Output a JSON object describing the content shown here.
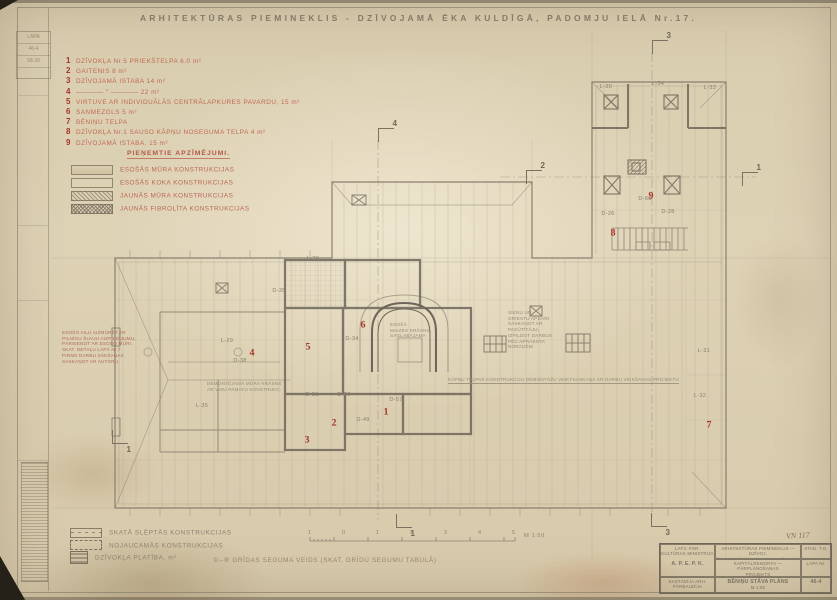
{
  "colors": {
    "paper": "#dcd0b4",
    "ink": "#7d7466",
    "accent_red": "#a8342a"
  },
  "title": "ARHITEKTŪRAS PIEMINEKLIS - DZĪVOJAMĀ ĒKA KULDĪGĀ, PADOMJU IELĀ Nr.17.",
  "corner_stamp": {
    "lines": [
      "LAPA",
      "46-4",
      "58-20"
    ]
  },
  "room_list": {
    "items": [
      {
        "num": "1",
        "text": "DZĪVOKĻA Nr.5 PRIEKŠTELPA 6.0 m²"
      },
      {
        "num": "2",
        "text": "GAITENIS 8 m²"
      },
      {
        "num": "3",
        "text": "DZĪVOJAMĀ ISTABA 14 m²"
      },
      {
        "num": "4",
        "text": "———— ʺ ————  22 m²"
      },
      {
        "num": "5",
        "text": "VIRTUVE AR INDIVIDUĀLĀS CENTRĀLAPKURES PAVARDU, 15 m²"
      },
      {
        "num": "6",
        "text": "SANMEZGLS 5 m²"
      },
      {
        "num": "7",
        "text": "BĒNIŅU TELPA"
      },
      {
        "num": "8",
        "text": "DZĪVOKĻA Nr.1 SAUSO KĀPŅU NOSEGUMA TELPA 4 m²"
      },
      {
        "num": "9",
        "text": "DZĪVOJAMĀ ISTABA, 15 m²"
      }
    ]
  },
  "symbols_legend": {
    "heading": "PIEŅEMTIE APZĪMĒJUMI.",
    "items": [
      {
        "label": "ESOŠĀS MŪRA KONSTRUKCIJAS",
        "swatch": "existing-masonry"
      },
      {
        "label": "ESOŠĀS KOKA KONSTRUKCIJAS",
        "swatch": "existing-wood"
      },
      {
        "label": "JAUNĀS MŪRA KONSTRUKCIJAS",
        "swatch": "new-masonry"
      },
      {
        "label": "JAUNĀS FIBROLĪTA KONSTRUKCIJAS",
        "swatch": "new-fibrolite"
      }
    ]
  },
  "bottom_legend": {
    "items": [
      {
        "label": "SKATĀ SLĒPTĀS KONSTRUKCIJAS",
        "swatch": "hidden"
      },
      {
        "label": "NOJAUCAMĀS KONSTRUKCIJAS",
        "swatch": "demolish"
      },
      {
        "label": "DZĪVOKĻA PLATĪBA, m²",
        "swatch": "area"
      }
    ],
    "floor_note": "①–⑨  GRĪDAS SEGUMA VEIDS (SKAT. GRĪDU SEGUMU TABULĀ)",
    "scale_ticks": [
      "1",
      "0",
      "1",
      "2",
      "3",
      "4",
      "5"
    ],
    "scale_label": "M 1:50"
  },
  "plan": {
    "labels": [
      {
        "text": "L-38",
        "x": 313,
        "y": 259
      },
      {
        "text": "D-35",
        "x": 279,
        "y": 291
      },
      {
        "text": "D-34",
        "x": 352,
        "y": 339
      },
      {
        "text": "D-51",
        "x": 312,
        "y": 395
      },
      {
        "text": "D-58",
        "x": 344,
        "y": 395
      },
      {
        "text": "D-57",
        "x": 396,
        "y": 400
      },
      {
        "text": "D-49",
        "x": 363,
        "y": 420
      },
      {
        "text": "L-29",
        "x": 227,
        "y": 341
      },
      {
        "text": "D-38",
        "x": 240,
        "y": 361
      },
      {
        "text": "L-35",
        "x": 202,
        "y": 406
      },
      {
        "text": "L-31",
        "x": 704,
        "y": 351
      },
      {
        "text": "L-32",
        "x": 700,
        "y": 396
      },
      {
        "text": "L-30",
        "x": 606,
        "y": 87
      },
      {
        "text": "L-34",
        "x": 658,
        "y": 84
      },
      {
        "text": "L-33",
        "x": 710,
        "y": 88
      },
      {
        "text": "D-60",
        "x": 645,
        "y": 199
      },
      {
        "text": "D-26",
        "x": 608,
        "y": 214
      },
      {
        "text": "D-28",
        "x": 668,
        "y": 212
      }
    ],
    "red_markers": [
      {
        "n": "1",
        "x": 386,
        "y": 412
      },
      {
        "n": "2",
        "x": 334,
        "y": 423
      },
      {
        "n": "3",
        "x": 307,
        "y": 440
      },
      {
        "n": "4",
        "x": 252,
        "y": 353
      },
      {
        "n": "5",
        "x": 308,
        "y": 347
      },
      {
        "n": "6",
        "x": 363,
        "y": 325
      },
      {
        "n": "7",
        "x": 709,
        "y": 425
      },
      {
        "n": "8",
        "x": 613,
        "y": 233
      },
      {
        "n": "9",
        "x": 651,
        "y": 196
      }
    ],
    "section_flags": [
      {
        "n": "4",
        "x": 378,
        "y": 128,
        "dir": "down"
      },
      {
        "n": "3",
        "x": 652,
        "y": 40,
        "dir": "down"
      },
      {
        "n": "2",
        "x": 526,
        "y": 170,
        "dir": "down"
      },
      {
        "n": "1",
        "x": 742,
        "y": 172,
        "dir": "down"
      },
      {
        "n": "1",
        "x": 396,
        "y": 514,
        "dir": "up"
      },
      {
        "n": "3",
        "x": 651,
        "y": 513,
        "dir": "up"
      },
      {
        "n": "1",
        "x": 112,
        "y": 430,
        "dir": "up"
      }
    ],
    "notes": [
      {
        "x": 62,
        "y": 330,
        "style": "red",
        "lines": [
          "ESOŠO AILU AIZMŪRĒT AR",
          "PILNĪGU ŠUVJU AIZPILDĪJUMU,",
          "PĀRSIENOT AR ESOŠO MŪRI.",
          "SKAT. DETAĻU LAPĀ Nr.7.",
          "PIRMS DARBU SĀKŠANAS",
          "SASKAŅOT AR AUTORU"
        ]
      },
      {
        "x": 207,
        "y": 381,
        "style": "pencil",
        "lines": [
          "DEMONTĒJAMĀ MŪRA KRĀSNS",
          "AR VISU PAMATU KONSTRUKC."
        ]
      },
      {
        "x": 508,
        "y": 310,
        "style": "pencil",
        "lines": [
          "SIENU UN",
          "GRIESTU APDARI",
          "SASKAŅOT AR",
          "PASŪTĪTĀJU,",
          "IZPILDOT DARBUS",
          "PĒC APRAKSTA",
          "NORĀDĒM"
        ]
      },
      {
        "x": 448,
        "y": 377,
        "style": "pencil ul",
        "lines": [
          "KĀPŅU TELPAS KONSTRUKCIJU DEMONTĀŽU VEIKT",
          "SASKAŅĀ AR DARBU VEIKŠANAS PROJEKTU"
        ]
      },
      {
        "x": 390,
        "y": 322,
        "style": "pencil",
        "lines": [
          "ESOŠĀ",
          "MAIZES KRĀSNS",
          "SAGLABĀJAMA"
        ]
      }
    ]
  },
  "title_block": {
    "org1a": "LATV. PSR.",
    "org1b": "KULTŪRAS MINISTRIJA",
    "org2": "A. P. E. P. K.",
    "sig1": "SASTĀDĪJA ARH.",
    "sig2": "PĀRBAUDĪJA",
    "proj1": "ARHITEKTŪRAS PIEMINEKLIS — DZĪVOJ.",
    "proj1b": "ĒKA KULDĪGĀ, PADOMJU IELĀ Nr.17.",
    "proj2": "KAPITĀLREMONTA — PĀRPLĀNOŠANAS",
    "proj2b": "PROJEKTS",
    "draw1": "BĒNIŅU STĀVA PLĀNS",
    "draw2": "M 1:50",
    "r1": "STAD. T.D.",
    "r2": "LAPA Nr.",
    "r3": "46-4",
    "handwritten": "VN 117"
  }
}
